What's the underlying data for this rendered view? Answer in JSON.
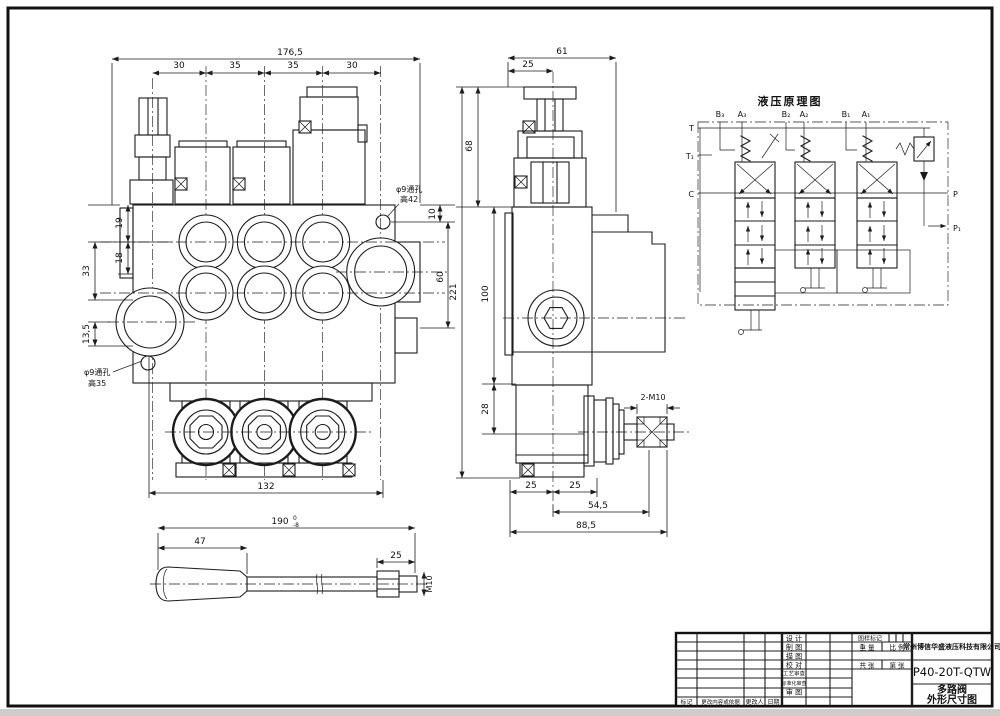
{
  "drawing": {
    "model": "P40-20T-QTW",
    "product_name": "多路阀",
    "sheet_title": "外形尺寸图"
  },
  "front_view": {
    "dim_overall": "176,5",
    "dim_segments": [
      "30",
      "35",
      "35",
      "30"
    ],
    "dim_left": [
      "19",
      "18",
      "33",
      "13,5"
    ],
    "dim_right_top": "10",
    "dim_right_side": "60",
    "dim_bottom": "132",
    "hole_top_line1": "φ9通孔",
    "hole_top_line2": "高42",
    "hole_bottom_line1": "φ9通孔",
    "hole_bottom_line2": "高35"
  },
  "side_view": {
    "dim_width": "61",
    "dim_width_half": "25",
    "dim_cap_height": "68",
    "dim_total_height": "221",
    "dim_body_height": "100",
    "dim_lower_height": "28",
    "dim_foot_left": "25",
    "dim_foot_right": "25",
    "dim_pivot_1": "54,5",
    "dim_pivot_2": "88,5",
    "pivot_thread": "2-M10"
  },
  "lever_view": {
    "dim_length": "190",
    "tol_upper": "0",
    "tol_lower": "-8",
    "dim_grip": "47",
    "dim_thread": "25",
    "thread_spec": "M10"
  },
  "schematic": {
    "title": "液压原理图",
    "ports_top": [
      "B₃",
      "A₃",
      "B₂",
      "A₂",
      "B₁",
      "A₁"
    ],
    "port_t": "T",
    "port_t1": "T₁",
    "port_c": "C",
    "port_p": "P",
    "port_p1": "P₁"
  },
  "title_block": {
    "company": "常州博信华盛液压科技有限公司",
    "model": "P40-20T-QTW",
    "product_name": "多路阀",
    "sheet_title": "外形尺寸图",
    "row_labels": [
      "设 计",
      "制 图",
      "描 图",
      "校 对",
      "工艺审查",
      "标准化审查",
      "审 图"
    ],
    "stamp_label": "图样标记",
    "weight_label": "重 量",
    "scale_label": "比 例",
    "total_sheets_label": "共  张",
    "sheet_number_label": "第  张",
    "revision_row": [
      "标记",
      "更改内容或依据",
      "更改人",
      "日期"
    ]
  }
}
